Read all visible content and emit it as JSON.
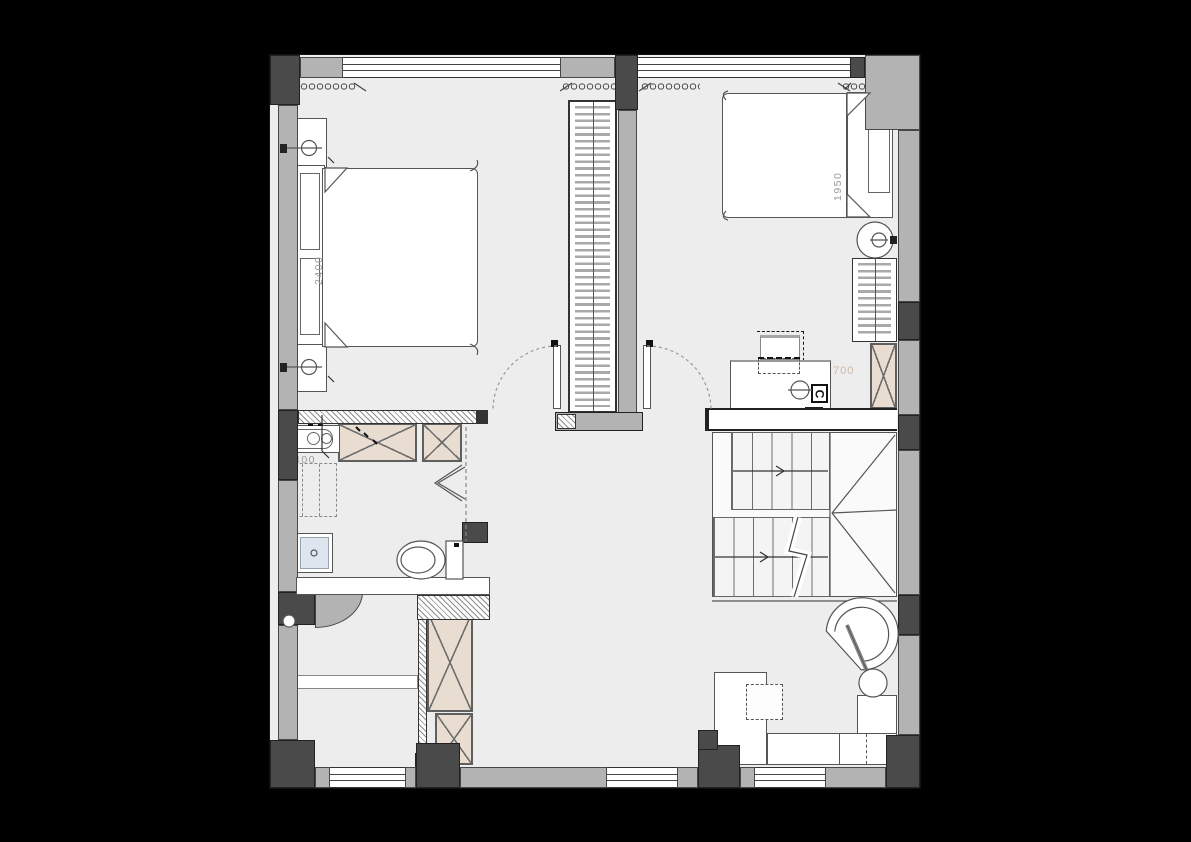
{
  "drawing": {
    "type": "floor-plan",
    "colors": {
      "background": "#000000",
      "floor": "#ededed",
      "wall_light": "#b3b3b3",
      "wall_dark": "#4a4a4a",
      "cabinet_fill": "#e9ddd1",
      "shower_fill": "#dde5ee",
      "line": "#555555",
      "dim_text": "#9b9b9b",
      "tan_text": "#cdb9a5"
    },
    "labels": {
      "bed_left_width": "2400",
      "bed_right_width": "1950",
      "vanity_width": "400",
      "desk_depth": "700",
      "column_marker": "C"
    }
  }
}
